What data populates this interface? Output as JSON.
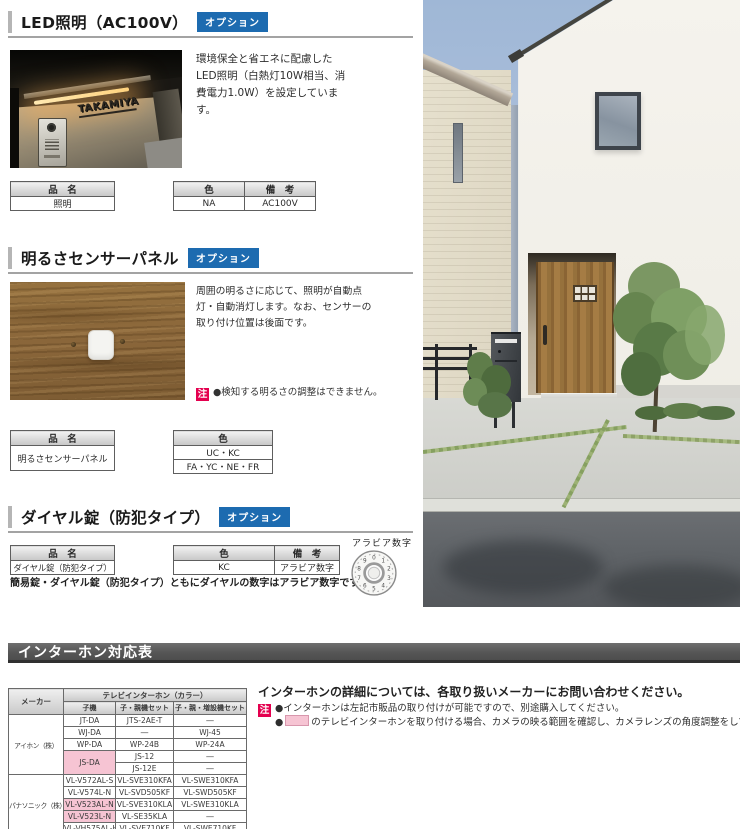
{
  "colors": {
    "option_badge_blue": "#1d6bb0",
    "note_badge_red": "#e4004f",
    "highlight_pink": "#f6c4d3",
    "banner_gray": "#565656"
  },
  "sections": {
    "led": {
      "title": "LED照明（AC100V）",
      "badge": "オプション",
      "description": "環境保全と省エネに配慮したLED照明（白熱灯10W相当、消費電力1.0W）を設定しています。",
      "photo_nameplate": "TAKAMIYA",
      "table": {
        "name_header": "品　名",
        "name_value": "照明",
        "color_header": "色",
        "color_value": "NA",
        "note_header": "備　考",
        "note_value": "AC100V"
      }
    },
    "sensor": {
      "title": "明るさセンサーパネル",
      "badge": "オプション",
      "description": "周囲の明るさに応じて、照明が自動点灯・自動消灯します。なお、センサーの取り付け位置は後面です。",
      "note_badge": "注",
      "note": "●検知する明るさの調整はできません。",
      "table": {
        "name_header": "品　名",
        "name_value": "明るさセンサーパネル",
        "color_header": "色",
        "color_values": [
          "UC・KC",
          "FA・YC・NE・FR"
        ]
      }
    },
    "dial_lock": {
      "title": "ダイヤル錠（防犯タイプ）",
      "badge": "オプション",
      "caption": "簡易錠・ダイヤル錠（防犯タイプ）ともにダイヤルの数字はアラビア数字です。",
      "dial_label": "アラビア数字",
      "dial_digits": [
        "0",
        "1",
        "2",
        "3",
        "4",
        "5",
        "6",
        "7",
        "8",
        "9"
      ],
      "table": {
        "name_header": "品　名",
        "name_value": "ダイヤル錠（防犯タイプ）",
        "color_header": "色",
        "color_value": "KC",
        "note_header": "備　考",
        "note_value": "アラビア数字"
      }
    }
  },
  "intercom": {
    "banner": "インターホン対応表",
    "info": "インターホンの詳細については、各取り扱いメーカーにお問い合わせください。",
    "note_badge": "注",
    "notes": [
      {
        "bullet": "●",
        "text": "インターホンは左記市販品の取り付けが可能ですので、別途購入してください。"
      },
      {
        "bullet": "●",
        "text": "のテレビインターホンを取り付ける場合、カメラの映る範囲を確認し、カメラレンズの角度調整をしてください。"
      }
    ],
    "table": {
      "maker_header": "メーカー",
      "group_header": "テレビインターホン（カラー）",
      "col_headers": [
        "子機",
        "子・親機セット",
        "子・親・増設機セット"
      ],
      "makers": [
        "アイホン（株）",
        "パナソニック（株）"
      ],
      "rows": [
        [
          "JT-DA",
          "JTS-2AE-T",
          "―"
        ],
        [
          "WJ-DA",
          "―",
          "WJ-45"
        ],
        [
          "WP-DA",
          "WP-24B",
          "WP-24A"
        ],
        [
          "JS-DA",
          "JS-12",
          "―"
        ],
        [
          "JS-12E",
          "―"
        ],
        [
          "VL-V572AL-S",
          "VL-SVE310KFA",
          "VL-SWE310KFA"
        ],
        [
          "VL-V574L-N",
          "VL-SVD505KF",
          "VL-SWD505KF"
        ],
        [
          "VL-V523AL-N",
          "VL-SVE310KLA",
          "VL-SWE310KLA"
        ],
        [
          "VL-V523L-N",
          "VL-SE35KLA",
          "―"
        ],
        [
          "VL-VH575AL-H",
          "VL-SVE710KF",
          "VL-SWE710KF"
        ]
      ]
    }
  }
}
